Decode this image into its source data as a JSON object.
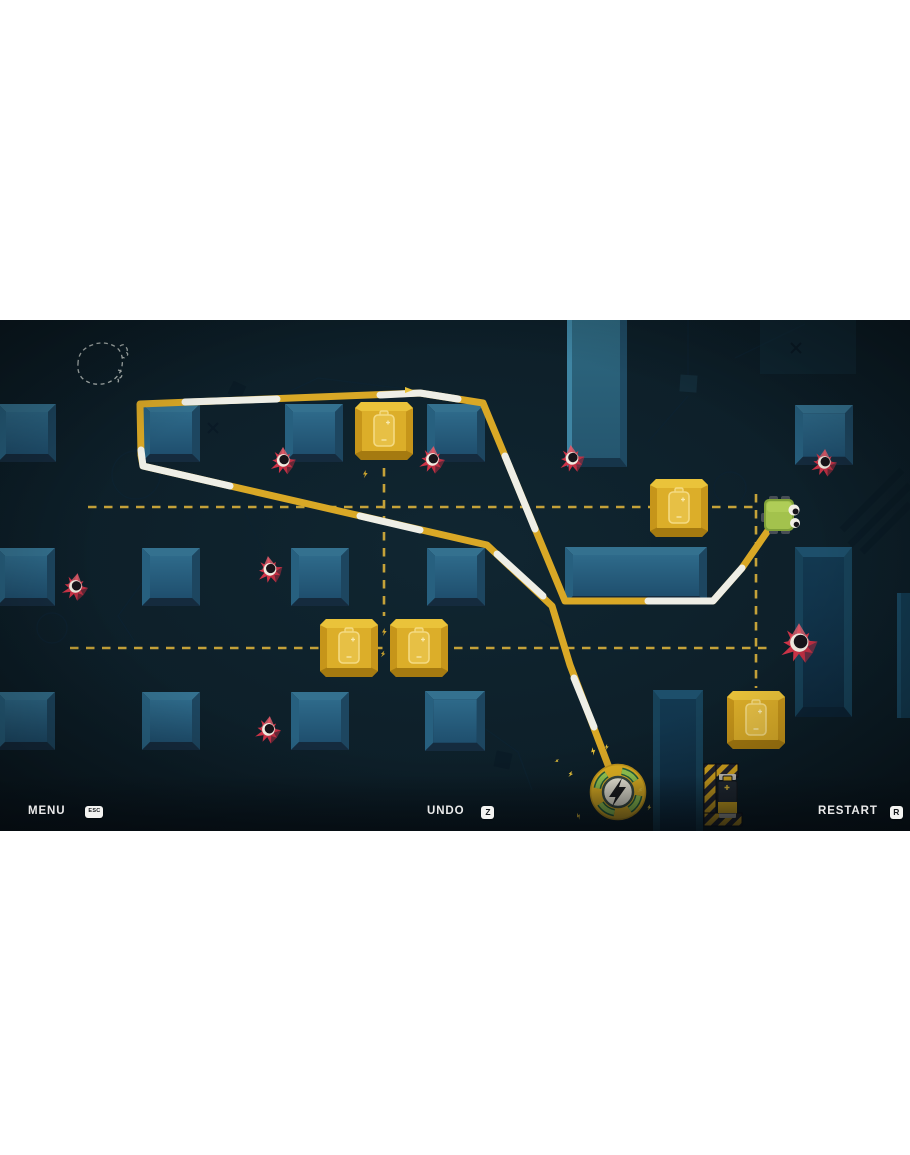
{
  "hud": {
    "menu": {
      "label": "MENU",
      "key": "ESC"
    },
    "undo": {
      "label": "UNDO",
      "key": "Z"
    },
    "restart": {
      "label": "RESTART",
      "key": "R"
    }
  },
  "scene": {
    "description": "Top-down cable-routing puzzle level: a green robot drags a yellow/white power cable from a round plug socket, winding between blue obstacle blocks, gold battery pickups and red spike mines. Yellow dashed guide lines link battery blocks.",
    "coordinate_space": "pixels in original 910x1155 screenshot",
    "game_area": {
      "x": 0,
      "y": 320,
      "width": 910,
      "height": 511
    },
    "robot": {
      "center": [
        780,
        515
      ],
      "facing": "right"
    },
    "power_socket": {
      "center": [
        618,
        792
      ],
      "icon": "lightning-bolt"
    },
    "battery_holder": {
      "center": [
        722,
        796
      ],
      "style": "hazard-striped bracket with battery"
    },
    "battery_blocks": [
      {
        "center": [
          384,
          431
        ]
      },
      {
        "center": [
          679,
          508
        ]
      },
      {
        "center": [
          349,
          648
        ]
      },
      {
        "center": [
          419,
          648
        ]
      },
      {
        "center": [
          756,
          720
        ]
      }
    ],
    "mines": [
      {
        "center": [
          283,
          462
        ]
      },
      {
        "center": [
          432,
          461
        ]
      },
      {
        "center": [
          572,
          460
        ]
      },
      {
        "center": [
          824,
          464
        ]
      },
      {
        "center": [
          75,
          588
        ]
      },
      {
        "center": [
          270,
          571
        ]
      },
      {
        "center": [
          268,
          731
        ]
      },
      {
        "center": [
          799,
          645
        ],
        "size": "large"
      }
    ],
    "cable_waypoints": [
      [
        769,
        529
      ],
      [
        742,
        568
      ],
      [
        713,
        601
      ],
      [
        565,
        601
      ],
      [
        483,
        403
      ],
      [
        420,
        393
      ],
      [
        140,
        404
      ],
      [
        141,
        455
      ],
      [
        143,
        466
      ],
      [
        487,
        545
      ],
      [
        552,
        606
      ],
      [
        570,
        665
      ],
      [
        616,
        786
      ]
    ],
    "guide_lines": [
      {
        "type": "horizontal",
        "y": 507,
        "from_x": 88,
        "to_x": 754
      },
      {
        "type": "vertical",
        "x": 384,
        "from_y": 468,
        "to_y": 616
      },
      {
        "type": "horizontal",
        "y": 648,
        "from_x": 70,
        "to_x": 772
      },
      {
        "type": "vertical",
        "x": 756,
        "from_y": 494,
        "to_y": 688
      }
    ],
    "sketch_circle": {
      "center": [
        100,
        364
      ],
      "style": "hand-drawn dashed"
    }
  },
  "colors": {
    "page_background": "#ffffff",
    "game_background": "#0c1e27",
    "cable_yellow": "#d9a826",
    "cable_white": "#eeeee6",
    "guide_dash": "#cfa93a",
    "block_blue": "#2a6787",
    "battery_gold": "#d9a81f",
    "mine_red": "#cf3448",
    "robot_green": "#a3c24d",
    "socket_green": "#96ca52",
    "hud_text": "#eaeaea"
  }
}
